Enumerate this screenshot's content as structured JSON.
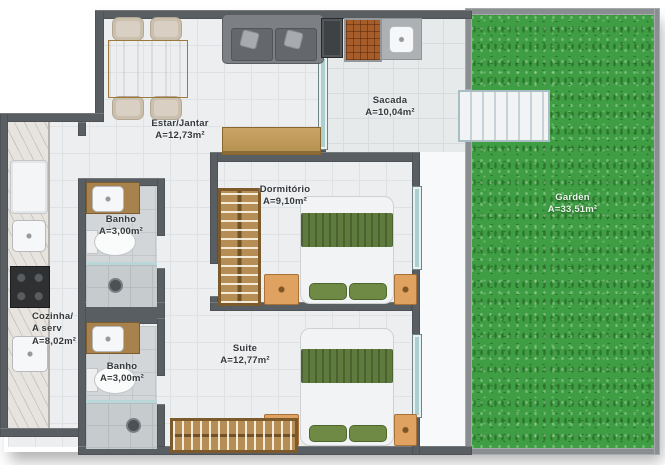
{
  "plan_title": "apartment-floor-plan",
  "rooms": {
    "estar": {
      "name": "Estar/Jantar",
      "area": "A=12,73m²"
    },
    "sacada": {
      "name": "Sacada",
      "area": "A=10,04m²"
    },
    "dormitorio": {
      "name": "Dormitório",
      "area": "A=9,10m²"
    },
    "banho1": {
      "name": "Banho",
      "area": "A=3,00m²"
    },
    "cozinha": {
      "line1": "Cozinha/",
      "line2": "A serv",
      "area": "A=8,02m²"
    },
    "suite": {
      "name": "Suite",
      "area": "A=12,77m²"
    },
    "banho2": {
      "name": "Banho",
      "area": "A=3,00m²"
    },
    "garden": {
      "name": "Garden",
      "area": "A=33,51m²"
    }
  },
  "colors": {
    "wall": "#595e62",
    "garden_wall": "#8a8e91",
    "floor_tile": "#eceef0",
    "bath_tile": "#d2d6d9",
    "grass": "#3f9e44",
    "wood": "#c9a266",
    "bed_blanket": "#5e7a3c",
    "nightstand": "#dfa260",
    "brick_grill": "#a75d2a",
    "window_glass": "#aecfd0",
    "label_text": "#35383b",
    "garden_label_text": "#edf5ed"
  }
}
